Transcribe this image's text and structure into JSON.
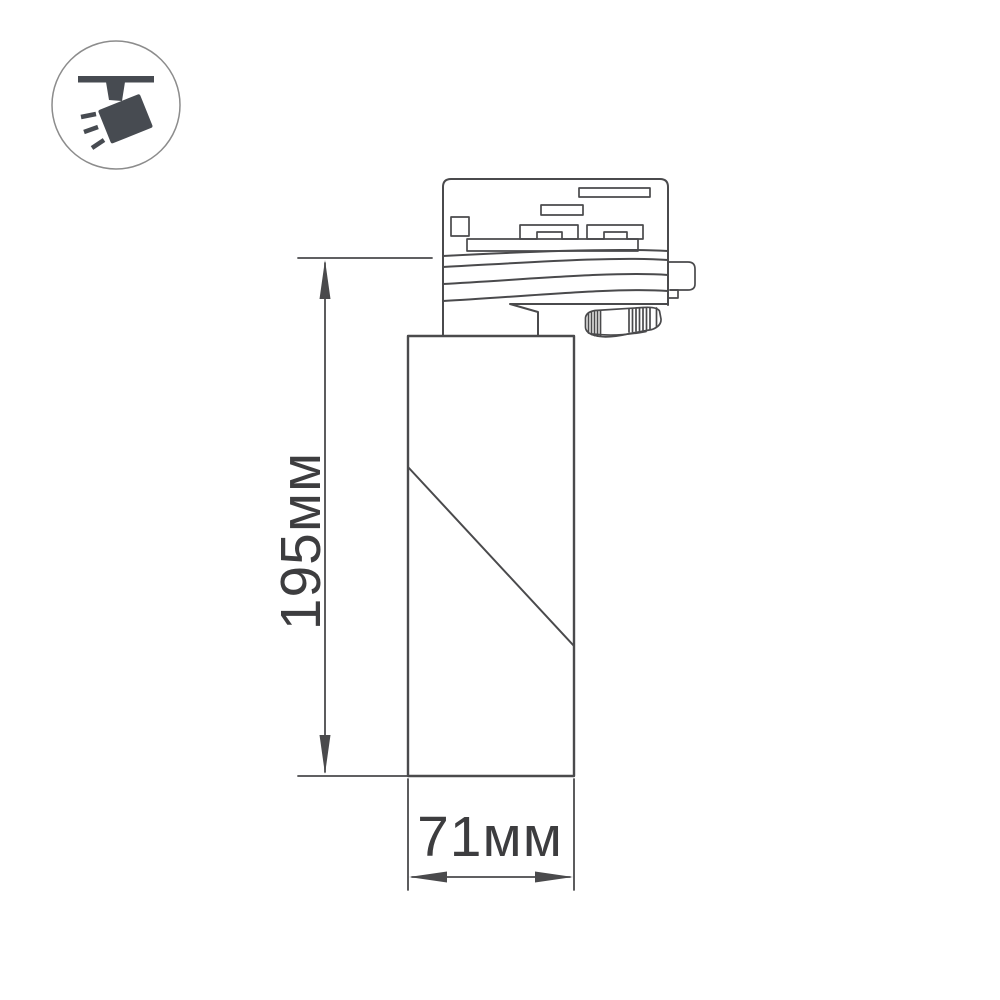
{
  "icons": {
    "badge": "ceiling-track-spotlight-icon"
  },
  "dimensions": {
    "height": {
      "label": "195мм"
    },
    "width": {
      "label": "71мм"
    }
  },
  "colors": {
    "line": "#4a4a4c",
    "text": "#3d3d3f",
    "icon": "#474b51",
    "circle": "#8c8c8c",
    "bg": "#ffffff"
  }
}
